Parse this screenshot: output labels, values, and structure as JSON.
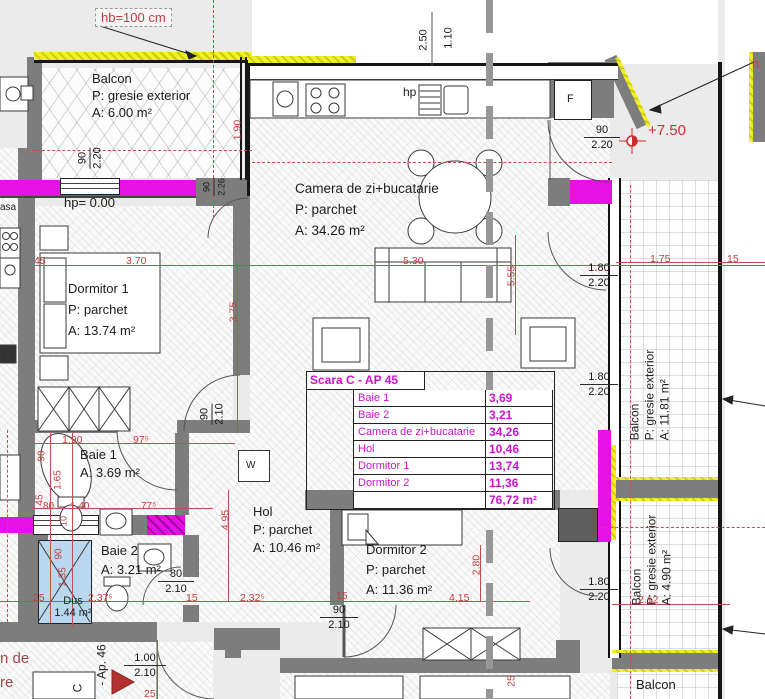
{
  "colors": {
    "wall_gray": "#7d7d7d",
    "insulation_yellow": "#f0f028",
    "highlight_magenta": "#e511e5",
    "dim_red": "#c04040",
    "table_magenta": "#ce12ce",
    "shower_blue": "#b9d7ee",
    "level_red": "#d03030"
  },
  "note_hb": "hb=100 cm",
  "level": "+7.50",
  "partials": {
    "top_right_h": "h",
    "left_asa": "asa",
    "bl_line1": "n de",
    "bl_line2": "re",
    "ap_ref": "- Ap. 46",
    "scara": "C"
  },
  "rooms": {
    "balcon_tl": {
      "name": "Balcon",
      "floor": "P: gresie exterior",
      "area": "A: 6.00 m²"
    },
    "camera": {
      "name": "Camera de zi+bucatarie",
      "floor": "P: parchet",
      "area": "A: 34.26 m²"
    },
    "dormitor1": {
      "name": "Dormitor 1",
      "floor": "P: parchet",
      "area": "A: 13.74 m²"
    },
    "baie1": {
      "name": "Baie 1",
      "area": "A: 3.69 m²"
    },
    "baie2": {
      "name": "Baie 2",
      "area": "A: 3.21 m²"
    },
    "hol": {
      "name": "Hol",
      "floor": "P: parchet",
      "area": "A: 10.46 m²"
    },
    "dormitor2": {
      "name": "Dormitor 2",
      "floor": "P: parchet",
      "area": "A: 11.36 m²"
    },
    "dus": {
      "name": "Dus",
      "area": "1.44 m²"
    },
    "balcon_r1": {
      "name": "Balcon",
      "floor": "P: gresie exterior",
      "area": "A: 11.81 m²"
    },
    "balcon_r2": {
      "name": "Balcon",
      "floor": "P: gresie exterior",
      "area": "A: 4.90 m²"
    },
    "balcon_br": {
      "name": "Balcon"
    }
  },
  "labels": {
    "hp_zero": "hp= 0.00",
    "hp": "hp",
    "fridge": "F",
    "washer": "W"
  },
  "area_table": {
    "title": "Scara C - AP 45",
    "rows": [
      {
        "label": "Baie 1",
        "value": "3,69"
      },
      {
        "label": "Baie 2",
        "value": "3,21"
      },
      {
        "label": "Camera de zi+bucatarie",
        "value": "34,26"
      },
      {
        "label": "Hol",
        "value": "10,46"
      },
      {
        "label": "Dormitor 1",
        "value": "13,74"
      },
      {
        "label": "Dormitor 2",
        "value": "11,36"
      }
    ],
    "total": "76,72 m²"
  },
  "door_sizes": {
    "balcony_tl": {
      "w": "90",
      "h": "2.20"
    },
    "top_right": {
      "w": "90",
      "h": "2.20"
    },
    "win1": {
      "w": "1.80",
      "h": "2.20"
    },
    "win2": {
      "w": "1.80",
      "h": "2.20"
    },
    "win3": {
      "w": "1.80",
      "h": "2.20"
    },
    "dormitor1": {
      "w": "90",
      "h": "2.10"
    },
    "hol": {
      "w": "90",
      "h": "2.10"
    },
    "baie2": {
      "w": "80",
      "h": "2.10"
    },
    "entry": {
      "w": "1.00",
      "h": "2.10"
    },
    "small": {
      "w": "90",
      "h": "2.26"
    }
  },
  "dims": {
    "d250": "2.50",
    "d110": "1.10",
    "d190": "1.90",
    "d45": "45",
    "d370": "3.70",
    "d530": "5.30",
    "d555": "5.55",
    "d175": "1.75",
    "d15a": "15",
    "d375": "3.75",
    "d190b": "1.90",
    "d975": "97⁵",
    "d90a": "90",
    "d165": "1.65",
    "d45b": "45",
    "d80": "80",
    "d140": "1.40",
    "d775": "77⁵",
    "d10": "10",
    "d90b": "90",
    "d135": "1.35",
    "d25a": "25",
    "d2375": "2.37⁵",
    "d15b": "15",
    "d2325": "2.32⁵",
    "d15c": "15",
    "d415": "4.15",
    "d280": "2.80",
    "d495": "4.95",
    "d212": "2.12",
    "d25b": "25",
    "d25c": "25"
  }
}
